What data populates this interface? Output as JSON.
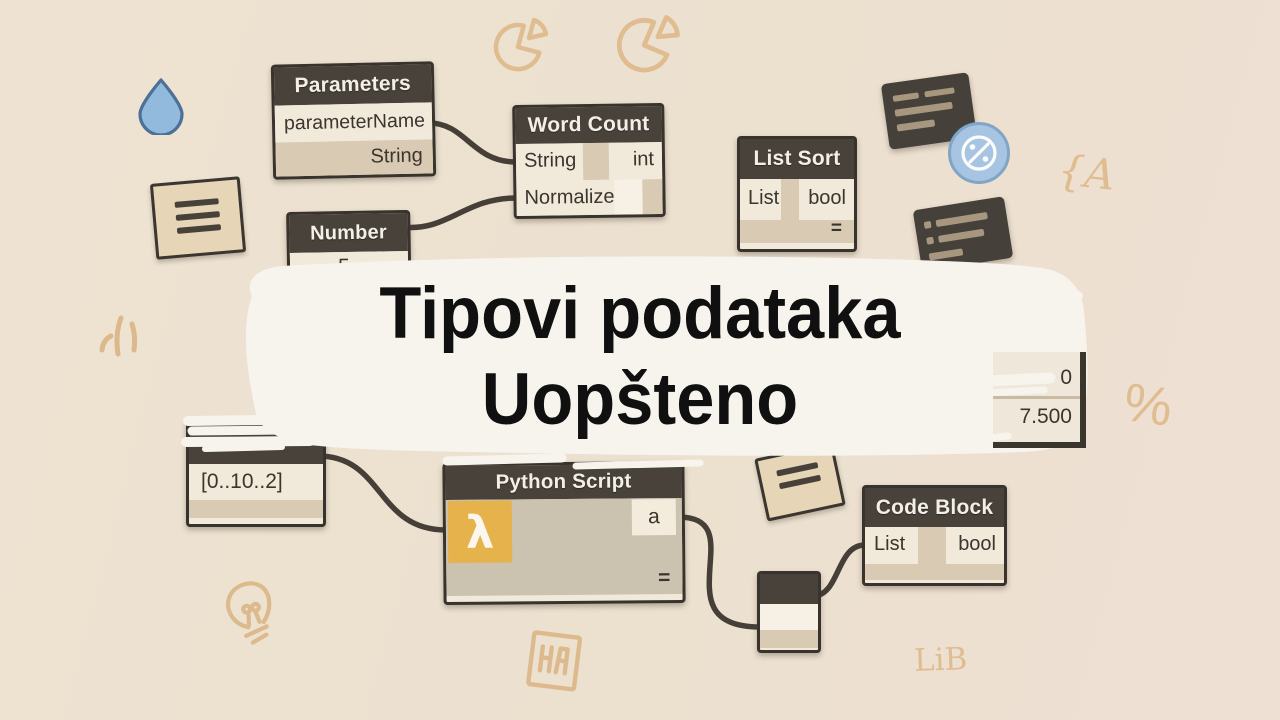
{
  "title": {
    "line1": "Tipovi podataka",
    "line2": "Uopšteno"
  },
  "nodes": {
    "parameters": {
      "title": "Parameters",
      "row1": "parameterName",
      "row2": "String"
    },
    "word_count": {
      "title": "Word Count",
      "in1": "String",
      "out1": "int",
      "in2": "Normalize"
    },
    "number": {
      "title": "Number",
      "value": "5"
    },
    "list_sort": {
      "title": "List Sort",
      "in1": "List",
      "out1": "bool",
      "eq": "="
    },
    "range": {
      "value": "[0..10..2]"
    },
    "python_script": {
      "title": "Python Script",
      "lambda_glyph": "λ",
      "out1": "a",
      "eq": "="
    },
    "code_block": {
      "title": "Code Block",
      "in1": "List",
      "out1": "bool"
    },
    "partial": {
      "row1": "0",
      "row2": "7.500"
    }
  },
  "doodles": {
    "brace": "{A",
    "percent": "%",
    "monogram_box": "HA",
    "lib": "LiB"
  },
  "colors": {
    "background": "#ece1d0",
    "node_header": "#48423a",
    "node_border": "#38332c",
    "cell_light": "#f1eadb",
    "cell_tan": "#d8cab3",
    "python_body": "#cbc2b0",
    "lambda_orange": "#e6b24b",
    "wire": "#453f38",
    "doodle_tan": "#e0bd90",
    "badge_blue": "#a7c5e2",
    "drop_blue": "#91badd",
    "dark_card": "#454039",
    "beige_card": "#e6d6b7",
    "banner_white": "#f7f4ee",
    "title_text": "#101010"
  }
}
